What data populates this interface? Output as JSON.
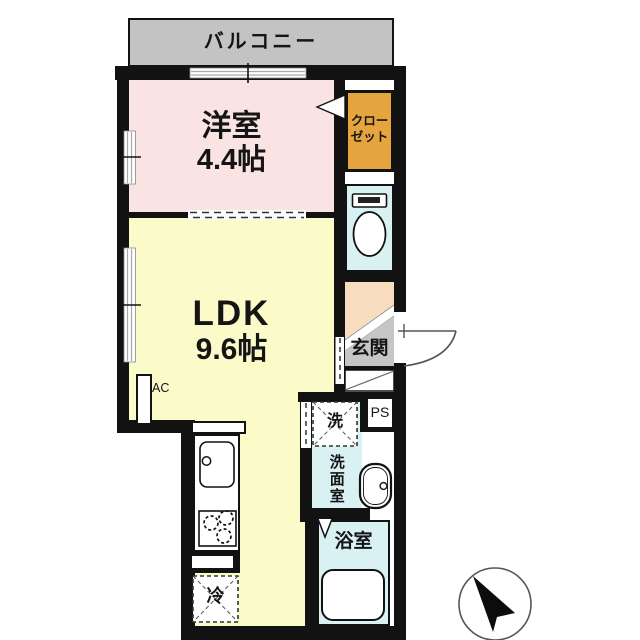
{
  "floorplan": {
    "balcony": {
      "label": "バルコニー"
    },
    "western_room": {
      "name": "洋室",
      "size": "4.4帖"
    },
    "closet": {
      "line1": "クロー",
      "line2": "ゼット"
    },
    "ldk": {
      "name": "LDK",
      "size": "9.6帖"
    },
    "entrance": {
      "label": "玄関"
    },
    "washroom": {
      "label": "洗面室"
    },
    "washer": {
      "label": "洗"
    },
    "bathroom": {
      "label": "浴室"
    },
    "fridge": {
      "label": "冷"
    },
    "ac": {
      "label": "AC"
    },
    "ps": {
      "label": "PS"
    },
    "icons": [
      "compass-north-icon",
      "toilet-icon",
      "bathtub-icon",
      "vanity-basin-icon",
      "kitchen-sink-icon",
      "stove-burners-icon",
      "entrance-door-arc-icon",
      "window-icon",
      "sliding-door-icon"
    ],
    "colors": {
      "wall": "#121212",
      "balcony": "#c3c3c3",
      "western_room": "#fae3e3",
      "ldk": "#fbfac9",
      "closet": "#e6a43e",
      "sanitary": "#d9f1f3",
      "hall": "#f8dcbf",
      "entrance_gray": "#c6c6c6"
    }
  }
}
